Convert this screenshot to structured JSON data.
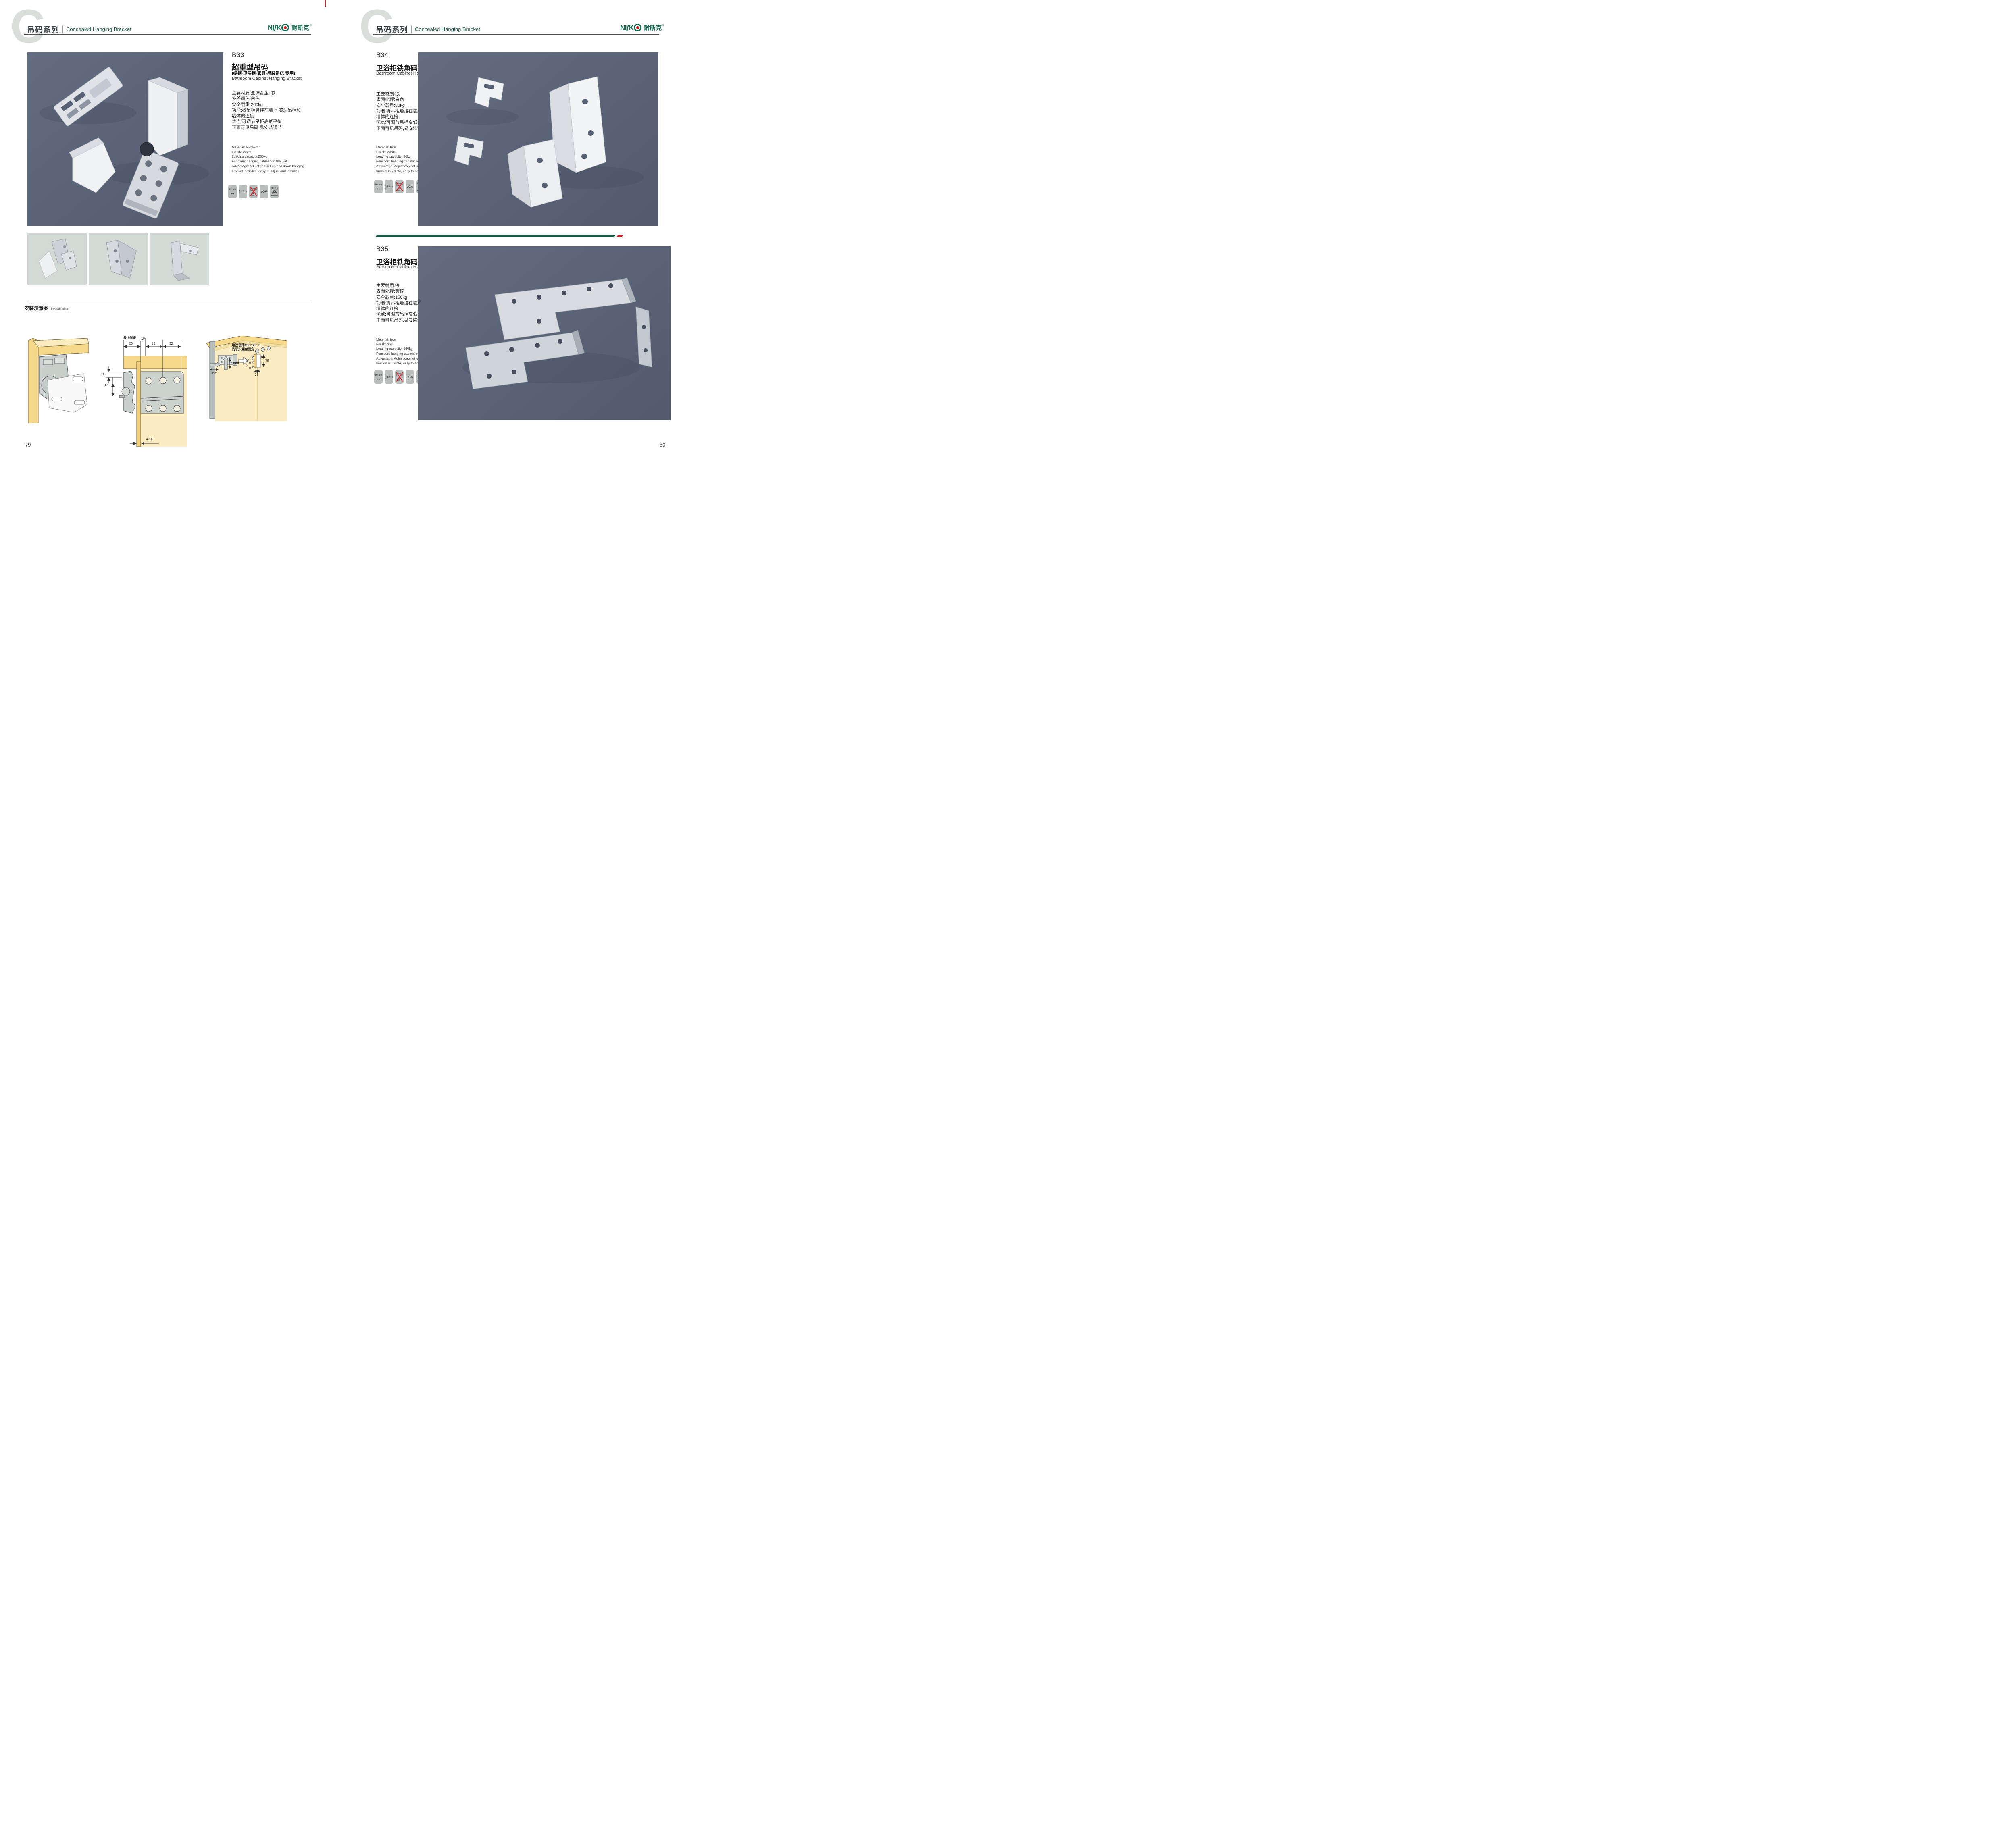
{
  "colors": {
    "brand_green": "#0f6a4e",
    "header_green": "#1a5b4b",
    "accent_red": "#c8242c",
    "photo_background": "#5a6376",
    "thumb_background": "#d3d9d5",
    "icon_tile": "#b9bdbc"
  },
  "page_left": {
    "header": {
      "logo_letter": "C",
      "series_cn": "吊码系列",
      "series_en": "Concealed Hanging Bracket"
    },
    "brand": {
      "ni": "NI",
      "s": "ʃ",
      "k": "K",
      "cn": "耐斯克",
      "reg": "®"
    },
    "product": {
      "code": "B33",
      "title_cn": "超重型吊码",
      "subtitle_cn": "(橱柜·卫浴柜·家具·吊装系统 专用)",
      "title_en": "Bathroom Cabinet Hanging Bracket",
      "specs_cn": [
        "主要材质:全锌合金+铁",
        "外盖颜色:白色",
        "安全载重:260kg",
        "功能:将吊柜悬挂在墙上,实现吊柜和",
        "墙体的连接",
        "优点:可调节吊柜高低平衡",
        "正面可见吊码,易安装调节"
      ],
      "specs_en": [
        "Material: Alloy+iron",
        "Finish: White",
        "Loading capacity:260kg",
        "Function: hanging cabinet on the wall",
        "Advantage: Adjust cabinet up and down hanging",
        "bracket is visible, easy to adjust and installed"
      ],
      "icons": {
        "width": "12mm",
        "height": "13mm",
        "no_drill": "no-drill",
        "lga": "LGA",
        "weight": "260Kg"
      }
    },
    "installation": {
      "title_cn": "安装示意图",
      "title_en": "Installation",
      "diagram2": {
        "min_gap_label": "最小间距",
        "dim_20": "20",
        "dim_10": "10",
        "dim_32a": "32",
        "dim_32b": "32",
        "dim_11": "11",
        "dim_32c": "32",
        "dim_bottom": "4-14"
      },
      "diagram3": {
        "note_line1": "建议使用M6x12mm",
        "note_line2": "的平头螺丝固定",
        "dim_78": "78",
        "dim_37": "37",
        "dim_9_vertical": "9mm",
        "dim_9_horizontal": "9mm"
      }
    },
    "page_number": "79"
  },
  "page_right": {
    "header": {
      "logo_letter": "C",
      "series_cn": "吊码系列",
      "series_en": "Concealed Hanging Bracket"
    },
    "brand": {
      "ni": "NI",
      "s": "ʃ",
      "k": "K",
      "cn": "耐斯克",
      "reg": "®"
    },
    "product_b34": {
      "code": "B34",
      "title_cn": "卫浴柜铁角码(分左右)",
      "title_en": "Bathroom Cabinet Hanging Bracket",
      "specs_cn": [
        "主要材质:铁",
        "表面处理:白色",
        "安全载重:80kg",
        "功能:将吊柜悬挂在墙上,实现吊柜和",
        "墙体的连接",
        "优点:可调节吊柜高低平衡",
        "正面可见吊码,易安装调节"
      ],
      "specs_en": [
        "Material: Iron",
        "Finish: White",
        "Loading capacity: 80kg",
        "Function: hanging cabinet on the wall",
        "Advantage: Adjust cabinet up and down hanging",
        "bracket is visible, easy to adjust and installed"
      ],
      "icons": {
        "width": "10mm",
        "height": "15mm",
        "no_drill": "no-drill",
        "lga": "LGA",
        "weight": "80Kg"
      }
    },
    "product_b35": {
      "code": "B35",
      "title_cn": "卫浴柜铁角码(分左右)",
      "title_en": "Bathroom Cabinet Hanging Bracket",
      "specs_cn": [
        "主要材质:铁",
        "表面处理:镀锌",
        "安全载重:160kg",
        "功能:将吊柜悬挂在墙上,实现吊柜和",
        "墙体的连接",
        "优点:可调节吊柜高低平衡",
        "正面可见吊码,易安装调节"
      ],
      "specs_en": [
        "Material: Iron",
        "Finish:Zinc",
        "Loading capacity: 160kg",
        "Function: hanging cabinet on the wall",
        "Advantage: Adjust cabinet up and down hanging",
        "bracket is visible, easy to adjust and installed"
      ],
      "icons": {
        "width": "10mm",
        "height": "15mm",
        "no_drill": "no-drill",
        "lga": "LGA",
        "weight": "160KG"
      }
    },
    "page_number": "80"
  }
}
